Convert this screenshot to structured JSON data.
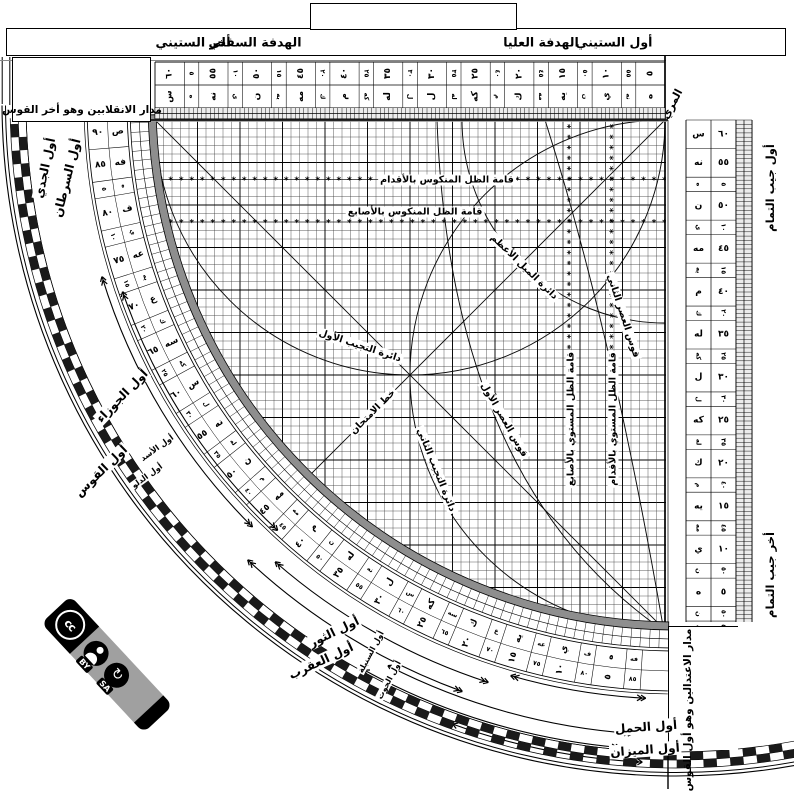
{
  "top_bar": {
    "awwal_sittini": "أول الستيني",
    "hadafa_ulya": "الهدفة العليا",
    "hadafa_sufla": "الهدفة السفلي",
    "akhir_sittini": "أخر الستيني"
  },
  "corners": {
    "muri": "المري",
    "solstice": "مدار الانقلابين وهو أخر القوس",
    "equinox": "مدار الاعتدالين وهو أول القوس",
    "cos_start": "أول جيب التمام",
    "cos_end": "أخر جيب التمام"
  },
  "grid_labels": {
    "mankus_aqdam": "قامة الظل المنكوس بالأقدام",
    "mankus_asabi": "قامة الظل المنكوس بالأصابع",
    "mayl": "دائرة الميل الأعظم",
    "asr2": "قوس العصر الثاني",
    "tajyib1": "دائرة التجيب الأول",
    "asr1": "قوس العصر الأول",
    "imtihan": "خط الامتحان",
    "tajyib2": "دائرة التجيب الثاني",
    "mustawi_asabi": "قامة الظل المستوي بالأصابع",
    "mustawi_aqdam": "قامة الظل المستوي بالأقدام"
  },
  "zodiac": {
    "jady": "أول الجدي",
    "saratan": "أول السرطان",
    "jawza": "أول الجوزاء",
    "qaws": "أول القوس",
    "asad": "أول الأسد",
    "dalw": "أول الدلو",
    "thawr": "أول الثور",
    "aqrab": "أول العقرب",
    "sunbula": "أول السنبلة",
    "hut": "أول الحوت",
    "hamal": "أول الحمل",
    "mizan": "أول الميزان"
  },
  "limb_scale": {
    "mains": [
      {
        "n": "٩٠",
        "a": "ص"
      },
      {
        "n": "٨٥",
        "a": "فه"
      },
      {
        "n": "٨٠",
        "a": "ف"
      },
      {
        "n": "٧٥",
        "a": "عه"
      },
      {
        "n": "٧٠",
        "a": "ع"
      },
      {
        "n": "٦٥",
        "a": "سه"
      },
      {
        "n": "٦٠",
        "a": "س"
      },
      {
        "n": "٥٥",
        "a": "نه"
      },
      {
        "n": "٥٠",
        "a": "ن"
      },
      {
        "n": "٤٥",
        "a": "مه"
      },
      {
        "n": "٤٠",
        "a": "م"
      },
      {
        "n": "٣٥",
        "a": "له"
      },
      {
        "n": "٣٠",
        "a": "ل"
      },
      {
        "n": "٢٥",
        "a": "كه"
      },
      {
        "n": "٢٠",
        "a": "ك"
      },
      {
        "n": "١٥",
        "a": "يه"
      },
      {
        "n": "١٠",
        "a": "ي"
      },
      {
        "n": "٥",
        "a": "ه"
      }
    ],
    "comps": [
      {
        "n": "٥",
        "a": "ه"
      },
      {
        "n": "١٠",
        "a": "ي"
      },
      {
        "n": "١٥",
        "a": "يه"
      },
      {
        "n": "٢٠",
        "a": "ك"
      },
      {
        "n": "٢٥",
        "a": "كه"
      },
      {
        "n": "٣٠",
        "a": "ل"
      },
      {
        "n": "٣٥",
        "a": "له"
      },
      {
        "n": "٤٠",
        "a": "م"
      },
      {
        "n": "٤٥",
        "a": "مه"
      },
      {
        "n": "٥٠",
        "a": "ن"
      },
      {
        "n": "٥٥",
        "a": "نه"
      },
      {
        "n": "٦٠",
        "a": "س"
      },
      {
        "n": "٦٥",
        "a": "سه"
      },
      {
        "n": "٧٠",
        "a": "ع"
      },
      {
        "n": "٧٥",
        "a": "عه"
      },
      {
        "n": "٨٠",
        "a": "ف"
      },
      {
        "n": "٨٥",
        "a": "فه"
      }
    ]
  },
  "right_scale": {
    "mains": [
      {
        "n": "٦٠",
        "a": "س"
      },
      {
        "n": "٥٥",
        "a": "نه"
      },
      {
        "n": "٥٠",
        "a": "ن"
      },
      {
        "n": "٤٥",
        "a": "مه"
      },
      {
        "n": "٤٠",
        "a": "م"
      },
      {
        "n": "٣٥",
        "a": "له"
      },
      {
        "n": "٣٠",
        "a": "ل"
      },
      {
        "n": "٢٥",
        "a": "كه"
      },
      {
        "n": "٢٠",
        "a": "ك"
      },
      {
        "n": "١٥",
        "a": "يه"
      },
      {
        "n": "١٠",
        "a": "ي"
      },
      {
        "n": "٥",
        "a": "ه"
      }
    ],
    "comps": [
      {
        "n": "٥",
        "a": "ه"
      },
      {
        "n": "١٠",
        "a": "ي"
      },
      {
        "n": "١٥",
        "a": "يه"
      },
      {
        "n": "٢٠",
        "a": "ك"
      },
      {
        "n": "٢٥",
        "a": "كه"
      },
      {
        "n": "٣٠",
        "a": "ل"
      },
      {
        "n": "٣٥",
        "a": "له"
      },
      {
        "n": "٤٠",
        "a": "م"
      },
      {
        "n": "٤٥",
        "a": "مه"
      },
      {
        "n": "٥٠",
        "a": "ن"
      },
      {
        "n": "٥٥",
        "a": "نه"
      }
    ]
  },
  "top_scale": {
    "mains": [
      {
        "n": "٥",
        "a": "ه"
      },
      {
        "n": "١٠",
        "a": "ي"
      },
      {
        "n": "١٥",
        "a": "يه"
      },
      {
        "n": "٢٠",
        "a": "ك"
      },
      {
        "n": "٢٥",
        "a": "كه"
      },
      {
        "n": "٣٠",
        "a": "ل"
      },
      {
        "n": "٣٥",
        "a": "له"
      },
      {
        "n": "٤٠",
        "a": "م"
      },
      {
        "n": "٤٥",
        "a": "مه"
      },
      {
        "n": "٥٠",
        "a": "ن"
      },
      {
        "n": "٥٥",
        "a": "نه"
      },
      {
        "n": "٦٠",
        "a": "س"
      }
    ],
    "comps": [
      {
        "n": "٥٥",
        "a": "نه"
      },
      {
        "n": "٥٠",
        "a": "ن"
      },
      {
        "n": "٤٥",
        "a": "مه"
      },
      {
        "n": "٤٠",
        "a": "م"
      },
      {
        "n": "٣٥",
        "a": "له"
      },
      {
        "n": "٣٠",
        "a": "ل"
      },
      {
        "n": "٢٥",
        "a": "كه"
      },
      {
        "n": "٢٠",
        "a": "ك"
      },
      {
        "n": "١٥",
        "a": "يه"
      },
      {
        "n": "١٠",
        "a": "ي"
      },
      {
        "n": "٥",
        "a": "ه"
      }
    ]
  },
  "license": {
    "cc": "cc",
    "by": "BY",
    "sa": "SA"
  }
}
